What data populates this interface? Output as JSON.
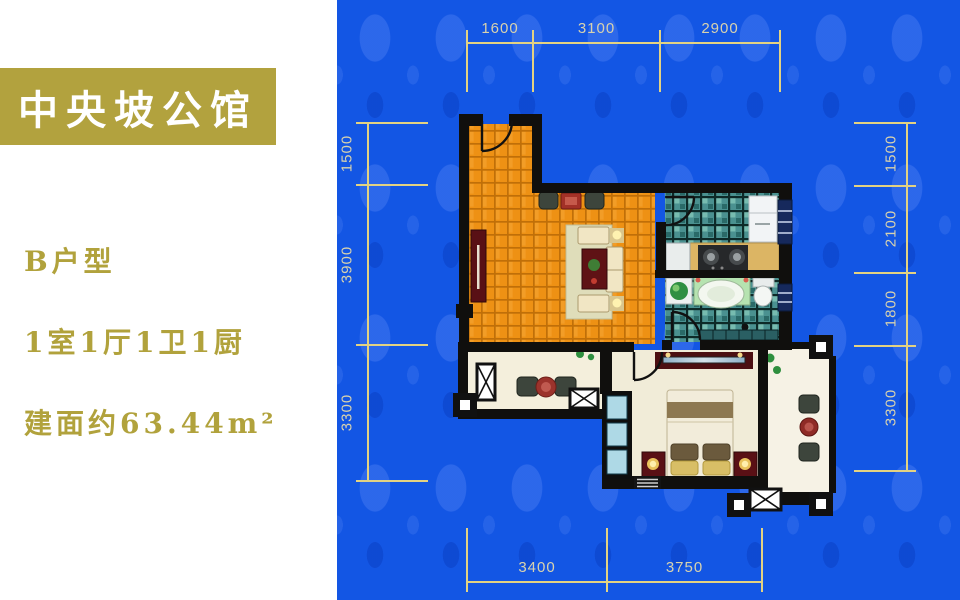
{
  "banner": {
    "title": "中央坡公馆"
  },
  "info": {
    "unit_type": "B户型",
    "layout": "1室1厅1卫1厨",
    "area": "建面约63.44m²"
  },
  "dimensions": {
    "top": [
      "1600",
      "3100",
      "2900"
    ],
    "left": [
      "1500",
      "3900",
      "3300"
    ],
    "right": [
      "1500",
      "2100",
      "1800",
      "3300"
    ],
    "bottom": [
      "3400",
      "3750"
    ]
  },
  "colors": {
    "background_blue": "#1356e4",
    "banner_gold": "#b2a23e",
    "text_gold": "#b1a23c",
    "dimension_line": "#e3d282",
    "dimension_text": "#d8d2ae",
    "wall_black": "#100f0d",
    "living_floor_orange": "#ee9114",
    "tile_teal": "#4a9190",
    "bedroom_floor_cream": "#f1ecd8"
  }
}
